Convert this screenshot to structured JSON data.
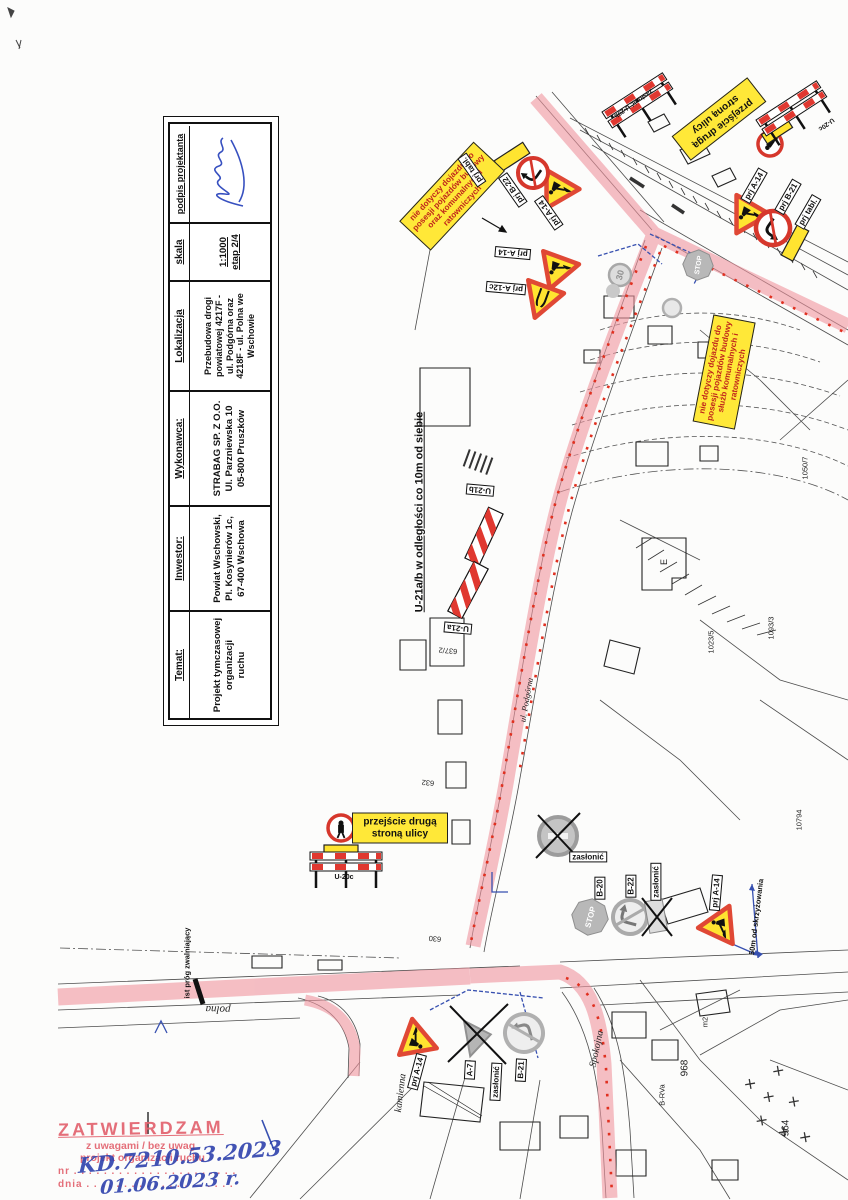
{
  "title_block": {
    "columns": [
      {
        "header": "Temat:",
        "body": "Projekt tymczasowej\norganizacji\nruchu"
      },
      {
        "header": "Inwestor:",
        "body": "Powiat Wschowski,\nPl. Kosynierów 1c,\n67-400 Wschowa"
      },
      {
        "header": "Wykonawca:",
        "body": "STRABAG SP. Z O.O.\nUl. Parzniewska 10\n05-800 Pruszków"
      },
      {
        "header": "Lokalizacja",
        "body": "Przebudowa drogi\npowiatowej 4217F -\nul. Podgórna oraz\n4218F - ul. Polna we\nWschowie"
      },
      {
        "header": "skala",
        "body": "1:1000\netap 2/4"
      },
      {
        "header": "podpis projektanta",
        "body": ""
      }
    ]
  },
  "stamp": {
    "title": "ZATWIERDZAM",
    "line2": "z uwagami / bez uwag",
    "line3": "projekt organizacji ruchu",
    "nr_line": "nr . . . . . . . . . . . . . . . . . . . . . .",
    "dnia_line": "dnia . . . . . . . . . . . . . . . . . . . .",
    "hand_nr": "KD.7210.53.2023",
    "hand_date": "01.06.2023 r."
  },
  "notes": {
    "u21_spacing": "U-21a/b w odległości co 10m od siebie",
    "cross_other_side": "przejście drugą\nstroną ulicy",
    "not_apply_a": "nie dotyczy dojazdu do\nposesji pojazdów budowy\noraz komunalnych i\nratowniczych",
    "not_apply_b": "nie dotyczy dojazdu do\nposesji pojazdów budowy\nsłużb komunalnych i\nratowniczych",
    "fifty_m": "50m od skrzyżowania",
    "speed_bump": "ist próg zwalniający",
    "zaslonic": "zasłonić",
    "u20b_cover": "zasłonić U-20b"
  },
  "sign_labels": {
    "prj_a14": "prj A-14",
    "prj_a12c": "prj A-12c",
    "prj_b21": "prj B-21",
    "prj_b22": "prj B-22",
    "prj_tabl": "prj tabl.",
    "a7": "A-7",
    "b20": "B-20",
    "b21": "B-21",
    "b22": "B-22",
    "u20c": "U-20c",
    "u21a": "U-21a",
    "u21b": "U-21b"
  },
  "signs_text": {
    "stop": "STOP",
    "thirty": "30"
  },
  "streets": {
    "polna": "polna",
    "kamienna": "kamienna",
    "spokojna": "Spokojna",
    "podgorna": "ul. Podgórna"
  },
  "parcels": {
    "n630": "630",
    "n632": "632",
    "n637": "637/2",
    "n964": "964",
    "n968": "968",
    "brva": "B-RVa",
    "n1093": "1093/3",
    "n1023": "1023/5",
    "n1050": "1050/7",
    "n10794": "10794",
    "e": "E",
    "m2": "m2"
  }
}
